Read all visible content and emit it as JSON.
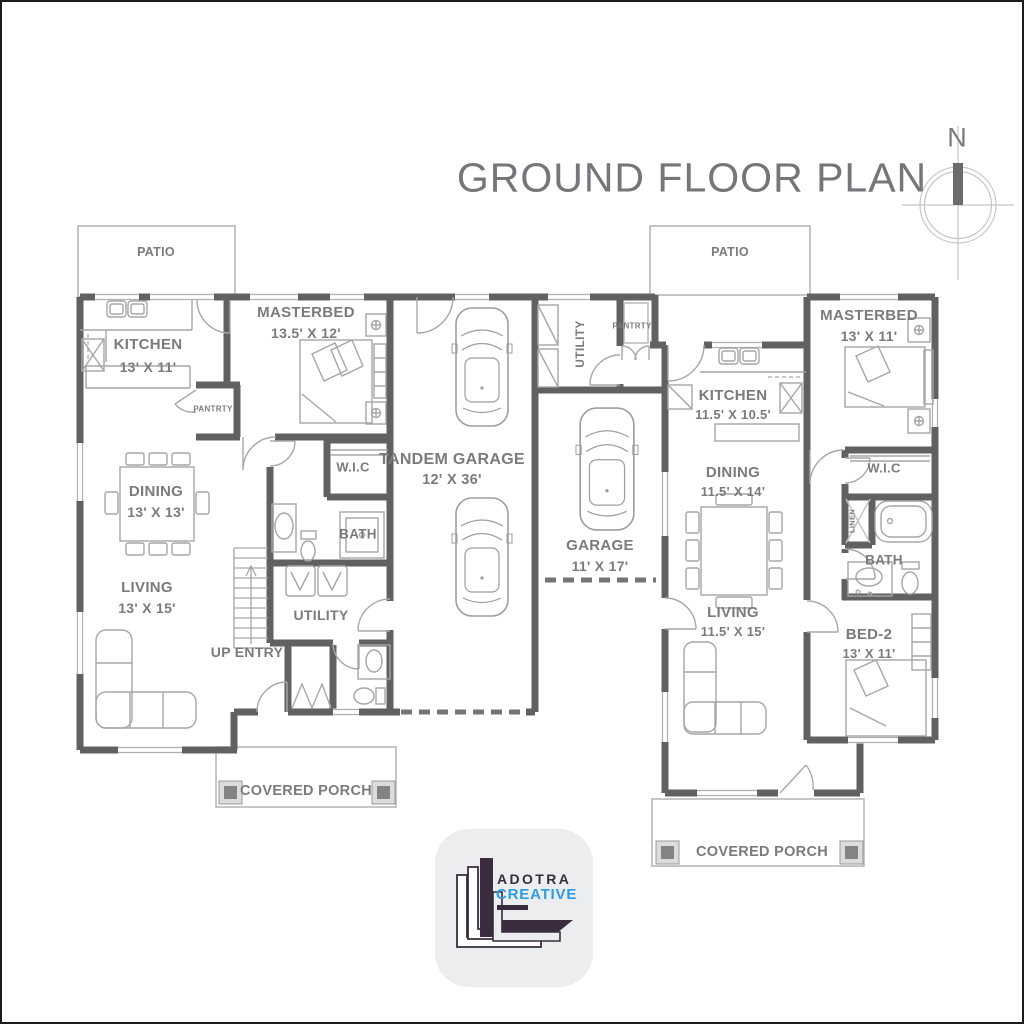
{
  "title": "GROUND FLOOR PLAN",
  "compass": {
    "north_label": "N"
  },
  "unit_left": {
    "patio_label": "PATIO",
    "kitchen_name": "KITCHEN",
    "kitchen_dim": "13' X 11'",
    "masterbed_name": "MASTERBED",
    "masterbed_dim": "13.5' X 12'",
    "pantry_label": "PANTRTY",
    "wic_label": "W.I.C",
    "dining_name": "DINING",
    "dining_dim": "13' X 13'",
    "bath_label": "BATH",
    "living_name": "LIVING",
    "living_dim": "13' X 15'",
    "utility_label": "UTILITY",
    "up_entry_label": "UP ENTRY",
    "porch_label": "COVERED PORCH",
    "tandem_garage_name": "TANDEM GARAGE",
    "tandem_garage_dim": "12' X 36'"
  },
  "unit_right": {
    "patio_label": "PATIO",
    "utility_label": "UTILITY",
    "pantry_label": "PANTRTY",
    "kitchen_name": "KITCHEN",
    "kitchen_dim": "11.5' X 10.5'",
    "masterbed_name": "MASTERBED",
    "masterbed_dim": "13' X 11'",
    "wic_label": "W.I.C",
    "linen_label": "LINEN",
    "bath_label": "BATH",
    "dining_name": "DINING",
    "dining_dim": "11.5' X 14'",
    "garage_name": "GARAGE",
    "garage_dim": "11' X 17'",
    "living_name": "LIVING",
    "living_dim": "11.5' X 15'",
    "bed2_name": "BED-2",
    "bed2_dim": "13' X 11'",
    "porch_label": "COVERED PORCH"
  },
  "logo": {
    "brand_line1": "ADOTRA",
    "brand_line2": "CREATIVE"
  },
  "colors": {
    "wall": "#616161",
    "thin_line": "#a6a6a6",
    "outline_light": "#b3b3b3",
    "label_text": "#7b7b7d",
    "title_text": "#75767a",
    "logo_dark": "#3a2c3e",
    "logo_blue": "#2b9de4"
  }
}
